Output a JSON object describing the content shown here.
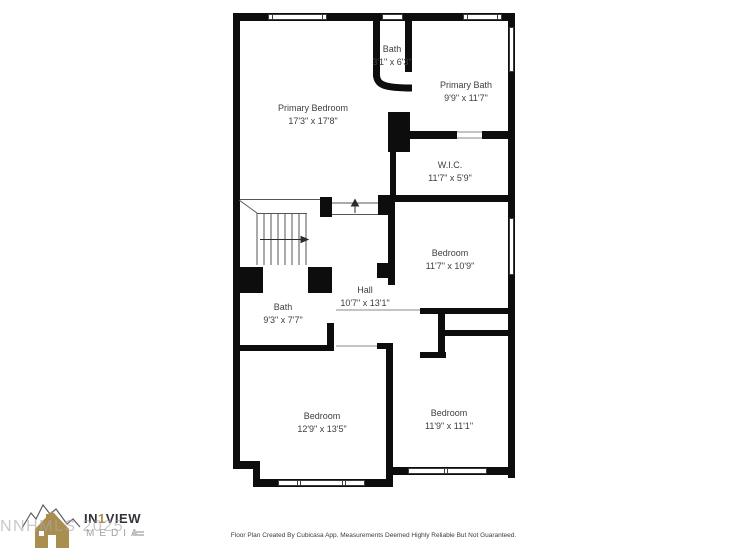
{
  "floor_plan": {
    "wall_color": "#0d0d0d",
    "rooms": [
      {
        "id": "primary-bedroom",
        "name": "Primary Bedroom",
        "dimensions": "17'3\" x 17'8\""
      },
      {
        "id": "bath-upper",
        "name": "Bath",
        "dimensions": "3'1\" x 6'3\""
      },
      {
        "id": "primary-bath",
        "name": "Primary Bath",
        "dimensions": "9'9\" x 11'7\""
      },
      {
        "id": "wic",
        "name": "W.I.C.",
        "dimensions": "11'7\" x 5'9\""
      },
      {
        "id": "bedroom-middle",
        "name": "Bedroom",
        "dimensions": "11'7\" x 10'9\""
      },
      {
        "id": "hall",
        "name": "Hall",
        "dimensions": "10'7\" x 13'1\""
      },
      {
        "id": "bath-middle",
        "name": "Bath",
        "dimensions": "9'3\" x 7'7\""
      },
      {
        "id": "bedroom-bottom-left",
        "name": "Bedroom",
        "dimensions": "12'9\" x 13'5\""
      },
      {
        "id": "bedroom-bottom-right",
        "name": "Bedroom",
        "dimensions": "11'9\" x 11'1\""
      }
    ],
    "stair_arrows": [
      "right",
      "up"
    ]
  },
  "branding": {
    "logo_prefix": "IN",
    "logo_number": "1",
    "logo_suffix": "VIEW",
    "logo_subtitle": "MEDIA",
    "watermark": "NNHMLS 2025",
    "gold_color": "#a98e50",
    "dark_color": "#32323a"
  },
  "footer": {
    "disclaimer": "Floor Plan Created By Cubicasa App. Measurements Deemed Highly Reliable But Not Guaranteed."
  }
}
